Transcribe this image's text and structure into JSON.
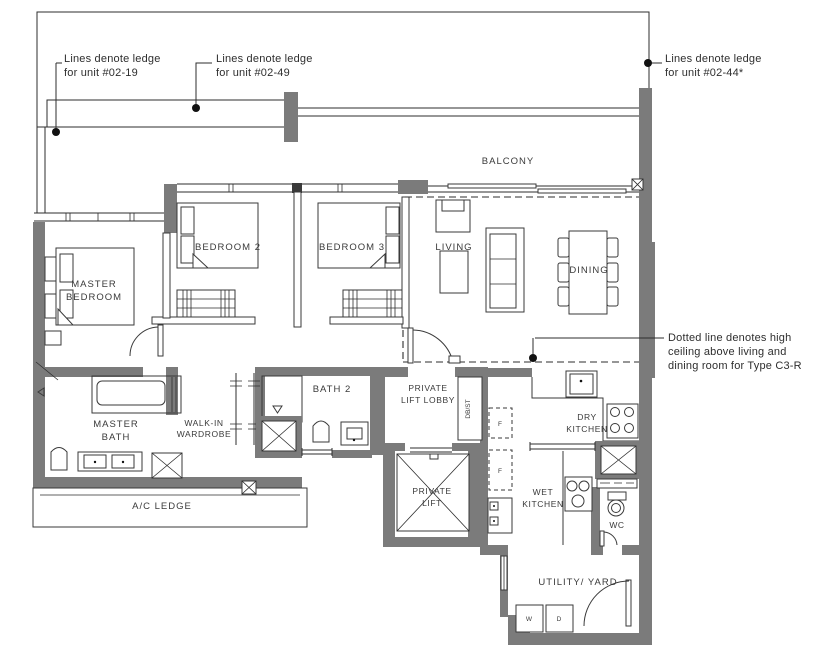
{
  "title": "Floor plan - Type C3-R unit",
  "colors": {
    "wall": "#7b7b7b",
    "line": "#2e2e2e",
    "text": "#3a3a3a",
    "background": "#ffffff"
  },
  "annotations": {
    "ledge_unit_02_19": {
      "line1": "Lines denote ledge",
      "line2": "for unit #02-19"
    },
    "ledge_unit_02_49": {
      "line1": "Lines denote ledge",
      "line2": "for unit #02-49"
    },
    "ledge_unit_02_44": {
      "line1": "Lines denote ledge",
      "line2": "for unit #02-44*"
    },
    "high_ceiling": {
      "line1": "Dotted line denotes high",
      "line2": "ceiling above living and",
      "line3": "dining room for Type C3-R"
    }
  },
  "rooms": {
    "balcony": "BALCONY",
    "master_bedroom": {
      "line1": "MASTER",
      "line2": "BEDROOM"
    },
    "bedroom2": "BEDROOM 2",
    "bedroom3": "BEDROOM 3",
    "living": "LIVING",
    "dining": "DINING",
    "master_bath": {
      "line1": "MASTER",
      "line2": "BATH"
    },
    "walk_in_wardrobe": {
      "line1": "WALK-IN",
      "line2": "WARDROBE"
    },
    "bath2": "BATH 2",
    "private_lift_lobby": {
      "line1": "PRIVATE",
      "line2": "LIFT LOBBY"
    },
    "private_lift": {
      "line1": "PRIVATE",
      "line2": "LIFT"
    },
    "db_st": "DB/ST",
    "dry_kitchen": {
      "line1": "DRY",
      "line2": "KITCHEN"
    },
    "wet_kitchen": {
      "line1": "WET",
      "line2": "KITCHEN"
    },
    "wc": "WC",
    "ac_ledge": "A/C LEDGE",
    "utility_yard": "UTILITY/ YARD",
    "washer": "W",
    "dryer": "D",
    "fridge1": "F",
    "fridge2": "F"
  }
}
